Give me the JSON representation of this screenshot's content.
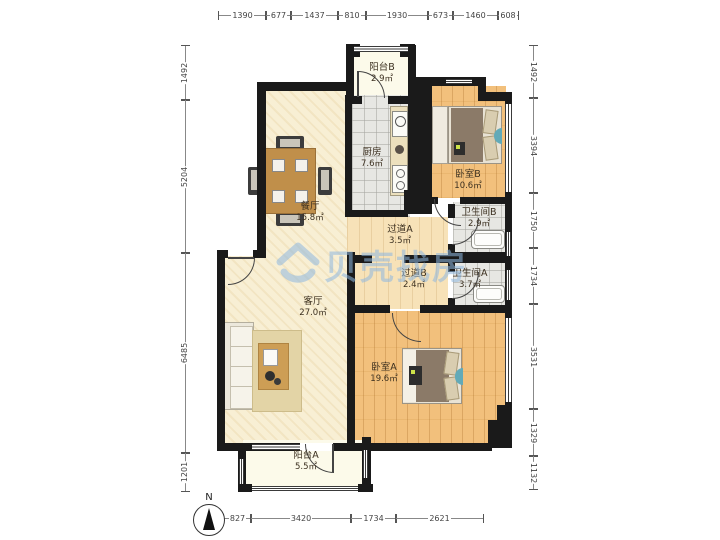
{
  "watermark": {
    "text": "贝壳找房"
  },
  "compass": {
    "label": "N"
  },
  "rooms": [
    {
      "id": "balcony-b",
      "name": "阳台B",
      "area": "2.9㎡"
    },
    {
      "id": "kitchen",
      "name": "厨房",
      "area": "7.6㎡"
    },
    {
      "id": "bedroom-b",
      "name": "卧室B",
      "area": "10.6㎡"
    },
    {
      "id": "dining",
      "name": "餐厅",
      "area": "15.8㎡"
    },
    {
      "id": "hallway-a",
      "name": "过道A",
      "area": "3.5㎡"
    },
    {
      "id": "bath-b",
      "name": "卫生间B",
      "area": "2.9㎡"
    },
    {
      "id": "hallway-b",
      "name": "过道B",
      "area": "2.4㎡"
    },
    {
      "id": "bath-a",
      "name": "卫生间A",
      "area": "3.7㎡"
    },
    {
      "id": "living",
      "name": "客厅",
      "area": "27.0㎡"
    },
    {
      "id": "bedroom-a",
      "name": "卧室A",
      "area": "19.6㎡"
    },
    {
      "id": "balcony-a",
      "name": "阳台A",
      "area": "5.5㎡"
    }
  ],
  "dimensions": {
    "top": [
      "1390",
      "677",
      "1437",
      "810",
      "1930",
      "673",
      "1460",
      "608"
    ],
    "left": [
      "1492",
      "5204",
      "6485",
      "1201"
    ],
    "right": [
      "1492",
      "3394",
      "1750",
      "1734",
      "3531",
      "1329",
      "1132"
    ],
    "bottom": [
      "827",
      "3420",
      "1734",
      "2621"
    ]
  }
}
